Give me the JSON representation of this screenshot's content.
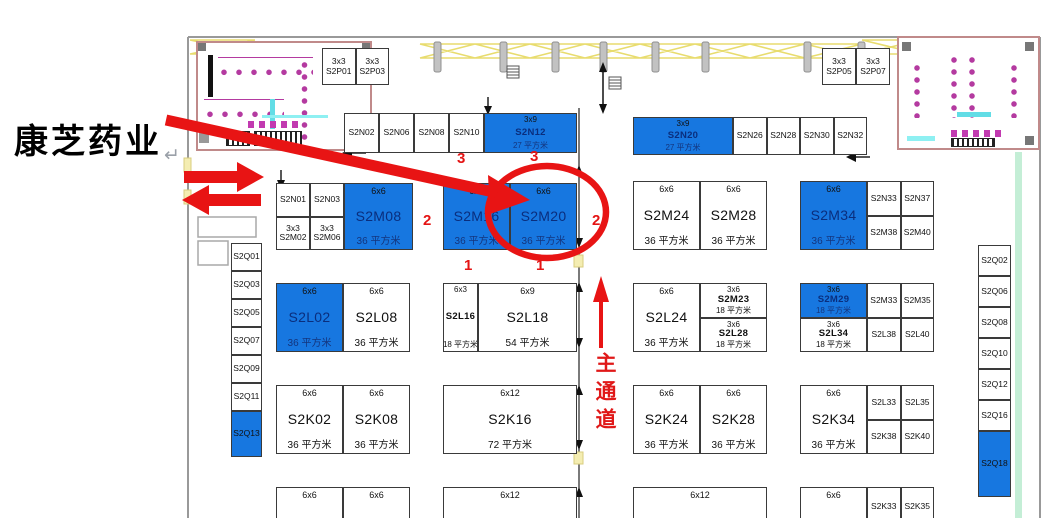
{
  "annotations": {
    "company_label": "康芝药业",
    "return_glyph": "↵",
    "main_aisle": "主通道",
    "markers": {
      "three_a": "3",
      "three_b": "3",
      "two_left": "2",
      "two_right": "2",
      "one_a": "1",
      "one_b": "1"
    }
  },
  "colors": {
    "booth_blue": "#1777e0",
    "annotation_red": "#e81414",
    "wall_pink": "#c08a8a",
    "truss_yellow": "#e8dc6e",
    "mint_strip": "#c4eed6"
  },
  "groups": [
    {
      "id": "p-left",
      "cells": [
        {
          "k": "m2",
          "size": "3x3",
          "code": "S2P01"
        },
        {
          "k": "m2",
          "size": "3x3",
          "code": "S2P03"
        }
      ]
    },
    {
      "id": "p-right",
      "cells": [
        {
          "k": "m2",
          "size": "3x3",
          "code": "S2P05"
        },
        {
          "k": "m2",
          "size": "3x3",
          "code": "S2P07"
        }
      ]
    },
    {
      "id": "n-left",
      "cells": [
        {
          "k": "m",
          "code": "S2N02"
        },
        {
          "k": "m",
          "code": "S2N06"
        },
        {
          "k": "m",
          "code": "S2N08"
        },
        {
          "k": "m",
          "code": "S2N10"
        },
        {
          "k": "f",
          "sm": 1,
          "b": 1,
          "w": 93,
          "size": "3x9",
          "code": "S2N12",
          "area": "27 平方米"
        }
      ]
    },
    {
      "id": "n-right",
      "cells": [
        {
          "k": "f",
          "sm": 1,
          "b": 1,
          "w": 100,
          "size": "3x9",
          "code": "S2N20",
          "area": "27 平方米"
        },
        {
          "k": "m",
          "code": "S2N26"
        },
        {
          "k": "m",
          "code": "S2N28"
        },
        {
          "k": "m",
          "code": "S2N30"
        },
        {
          "k": "m",
          "code": "S2N32"
        }
      ]
    },
    {
      "id": "m-left",
      "cells": [
        {
          "k": "g",
          "w": 68,
          "cells": [
            {
              "k": "m",
              "code": "S2N01"
            },
            {
              "k": "m",
              "code": "S2N03"
            },
            {
              "k": "m2",
              "size": "3x3",
              "code": "S2M02"
            },
            {
              "k": "m2",
              "size": "3x3",
              "code": "S2M06"
            }
          ]
        },
        {
          "k": "f",
          "b": 1,
          "size": "6x6",
          "code": "S2M08",
          "area": "36 平方米"
        }
      ]
    },
    {
      "id": "m-mid",
      "cells": [
        {
          "k": "f",
          "b": 1,
          "size": "6x6",
          "code": "S2M16",
          "area": "36 平方米"
        },
        {
          "k": "f",
          "b": 1,
          "size": "6x6",
          "code": "S2M20",
          "area": "36 平方米"
        }
      ]
    },
    {
      "id": "m-r1",
      "cells": [
        {
          "k": "f",
          "size": "6x6",
          "code": "S2M24",
          "area": "36 平方米"
        },
        {
          "k": "f",
          "size": "6x6",
          "code": "S2M28",
          "area": "36 平方米"
        }
      ]
    },
    {
      "id": "m-r2",
      "cells": [
        {
          "k": "f",
          "b": 1,
          "w": 67,
          "size": "6x6",
          "code": "S2M34",
          "area": "36 平方米"
        },
        {
          "k": "g",
          "cells": [
            {
              "k": "m",
              "code": "S2N33"
            },
            {
              "k": "m",
              "code": "S2N37"
            },
            {
              "k": "m",
              "code": "S2M38"
            },
            {
              "k": "m",
              "code": "S2M40"
            }
          ]
        }
      ]
    },
    {
      "id": "l-left",
      "cells": [
        {
          "k": "f",
          "b": 1,
          "size": "6x6",
          "code": "S2L02",
          "area": "36 平方米"
        },
        {
          "k": "f",
          "size": "6x6",
          "code": "S2L08",
          "area": "36 平方米"
        }
      ]
    },
    {
      "id": "l-mid",
      "cells": [
        {
          "k": "f",
          "sm": 1,
          "w": 35,
          "size": "6x3",
          "code": "S2L16",
          "area": "18 平方米"
        },
        {
          "k": "f",
          "size": "6x9",
          "code": "S2L18",
          "area": "54 平方米"
        }
      ]
    },
    {
      "id": "l-r1",
      "cells": [
        {
          "k": "f",
          "w": 67,
          "size": "6x6",
          "code": "S2L24",
          "area": "36 平方米"
        },
        {
          "k": "c",
          "cells": [
            {
              "k": "f",
              "sm": 1,
              "size": "3x6",
              "code": "S2M23",
              "area": "18 平方米"
            },
            {
              "k": "f",
              "sm": 1,
              "size": "3x6",
              "code": "S2L28",
              "area": "18 平方米"
            }
          ]
        }
      ]
    },
    {
      "id": "l-r2",
      "cells": [
        {
          "k": "c",
          "w": 67,
          "cells": [
            {
              "k": "f",
              "sm": 1,
              "b": 1,
              "size": "3x6",
              "code": "S2M29",
              "area": "18 平方米"
            },
            {
              "k": "f",
              "sm": 1,
              "size": "3x6",
              "code": "S2L34",
              "area": "18 平方米"
            }
          ]
        },
        {
          "k": "g",
          "cells": [
            {
              "k": "m",
              "code": "S2M33"
            },
            {
              "k": "m",
              "code": "S2M35"
            },
            {
              "k": "m",
              "code": "S2L38"
            },
            {
              "k": "m",
              "code": "S2L40"
            }
          ]
        }
      ]
    },
    {
      "id": "k-left",
      "cells": [
        {
          "k": "f",
          "size": "6x6",
          "code": "S2K02",
          "area": "36 平方米"
        },
        {
          "k": "f",
          "size": "6x6",
          "code": "S2K08",
          "area": "36 平方米"
        }
      ]
    },
    {
      "id": "k-mid",
      "cells": [
        {
          "k": "f",
          "size": "6x12",
          "code": "S2K16",
          "area": "72 平方米"
        }
      ]
    },
    {
      "id": "k-r1",
      "cells": [
        {
          "k": "f",
          "size": "6x6",
          "code": "S2K24",
          "area": "36 平方米"
        },
        {
          "k": "f",
          "size": "6x6",
          "code": "S2K28",
          "area": "36 平方米"
        }
      ]
    },
    {
      "id": "k-r2",
      "cells": [
        {
          "k": "f",
          "w": 67,
          "size": "6x6",
          "code": "S2K34",
          "area": "36 平方米"
        },
        {
          "k": "g",
          "cells": [
            {
              "k": "m",
              "code": "S2L33"
            },
            {
              "k": "m",
              "code": "S2L35"
            },
            {
              "k": "m",
              "code": "S2K38"
            },
            {
              "k": "m",
              "code": "S2K40"
            }
          ]
        }
      ]
    },
    {
      "id": "bot-left",
      "cells": [
        {
          "k": "s",
          "size": "6x6"
        },
        {
          "k": "s",
          "size": "6x6"
        }
      ]
    },
    {
      "id": "bot-mid",
      "cells": [
        {
          "k": "s",
          "size": "6x12"
        }
      ]
    },
    {
      "id": "bot-r1",
      "cells": [
        {
          "k": "s",
          "size": "6x12"
        }
      ]
    },
    {
      "id": "bot-r2",
      "cells": [
        {
          "k": "s",
          "w": 67,
          "size": "6x6"
        },
        {
          "k": "m",
          "code": "S2K33"
        },
        {
          "k": "m",
          "code": "S2K35"
        }
      ]
    },
    {
      "id": "q-left",
      "col": 1,
      "cells": [
        {
          "k": "m",
          "h": 28,
          "code": "S2Q01"
        },
        {
          "k": "m",
          "h": 28,
          "code": "S2Q03"
        },
        {
          "k": "m",
          "h": 28,
          "code": "S2Q05"
        },
        {
          "k": "m",
          "h": 28,
          "code": "S2Q07"
        },
        {
          "k": "m",
          "h": 28,
          "code": "S2Q09"
        },
        {
          "k": "m",
          "h": 28,
          "code": "S2Q11"
        },
        {
          "k": "m",
          "b": 1,
          "h": 46,
          "code": "S2Q13"
        }
      ]
    },
    {
      "id": "q-right",
      "col": 1,
      "cells": [
        {
          "k": "m",
          "h": 31,
          "code": "S2Q02"
        },
        {
          "k": "m",
          "h": 31,
          "code": "S2Q06"
        },
        {
          "k": "m",
          "h": 31,
          "code": "S2Q08"
        },
        {
          "k": "m",
          "h": 31,
          "code": "S2Q10"
        },
        {
          "k": "m",
          "h": 31,
          "code": "S2Q12"
        },
        {
          "k": "m",
          "h": 31,
          "code": "S2Q16"
        },
        {
          "k": "m",
          "b": 1,
          "h": 66,
          "code": "S2Q18"
        }
      ]
    }
  ]
}
